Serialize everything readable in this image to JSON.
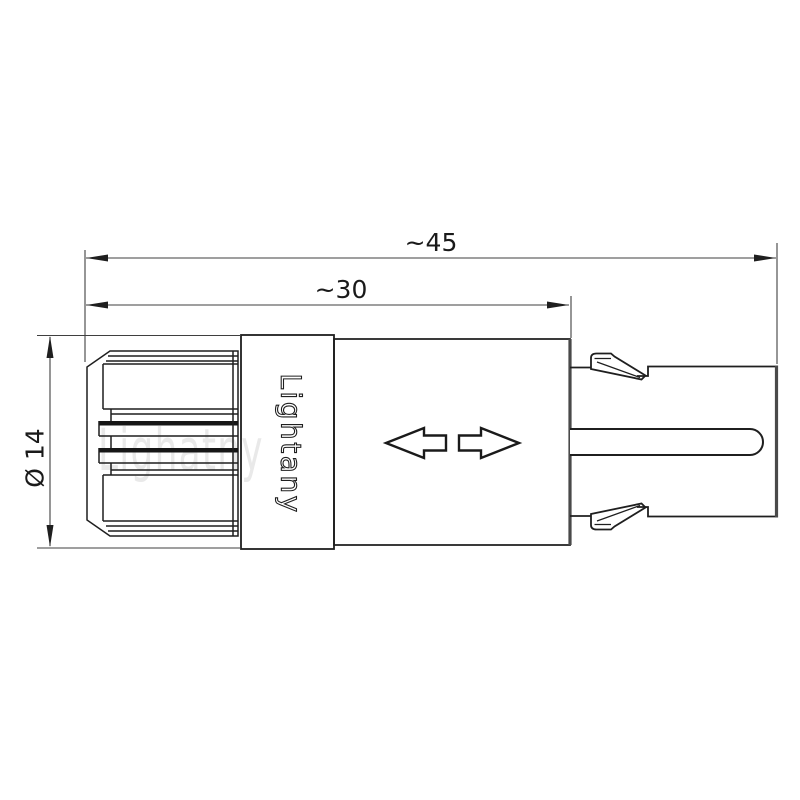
{
  "drawing": {
    "brand": "Lightany",
    "watermark": "Lighatny",
    "dims": {
      "overall_length": "~45",
      "front_length": "~30",
      "diameter": "Ø 14"
    },
    "colors": {
      "line": "#1f1f1f",
      "dim_line": "#3f3f3f",
      "thick_edge": "#4a4a4a",
      "watermark": "#e9e9e9",
      "fill": "#ffffff"
    }
  }
}
